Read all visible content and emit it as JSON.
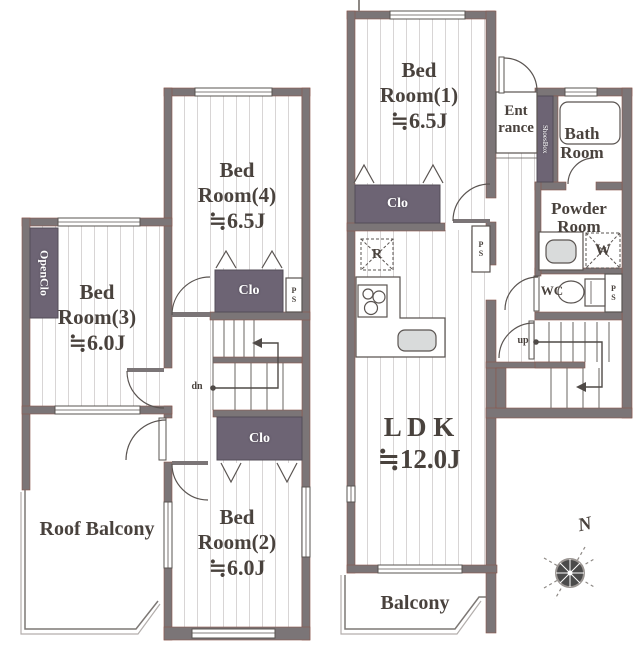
{
  "colors": {
    "wall": "#7b7577",
    "wall_edge": "#8a564c",
    "closet": "#6d6474",
    "stripe": "#d8d5d5",
    "text": "#49423d",
    "fixture": "#d9dbdb"
  },
  "second_floor": {
    "bedroom4": {
      "name": "Bed Room(4)",
      "size": "≒6.5J"
    },
    "bedroom3": {
      "name": "Bed Room(3)",
      "size": "≒6.0J"
    },
    "bedroom2": {
      "name": "Bed Room(2)",
      "size": "≒6.0J"
    },
    "roof_balcony": "Roof Balcony",
    "open_closet": "OpenClo",
    "closet_br4": "Clo",
    "closet_br2": "Clo",
    "ps": "PS",
    "stairs_down": "dn"
  },
  "first_floor": {
    "bedroom1": {
      "name": "Bed Room(1)",
      "size": "≒6.5J"
    },
    "ldk": {
      "name": "L D K",
      "size": "≒12.0J"
    },
    "entrance_line1": "Ent",
    "entrance_line2": "rance",
    "shoes_box": "ShoesBox",
    "bathroom_line1": "Bath",
    "bathroom_line2": "Room",
    "powder_line1": "Powder",
    "powder_line2": "Room",
    "wc": "WC",
    "closet_br1": "Clo",
    "refrigerator": "R",
    "washer": "W",
    "ps_kitchen": "PS",
    "ps_wc": "PS",
    "stairs_up": "up",
    "balcony": "Balcony"
  },
  "compass_north": "N"
}
